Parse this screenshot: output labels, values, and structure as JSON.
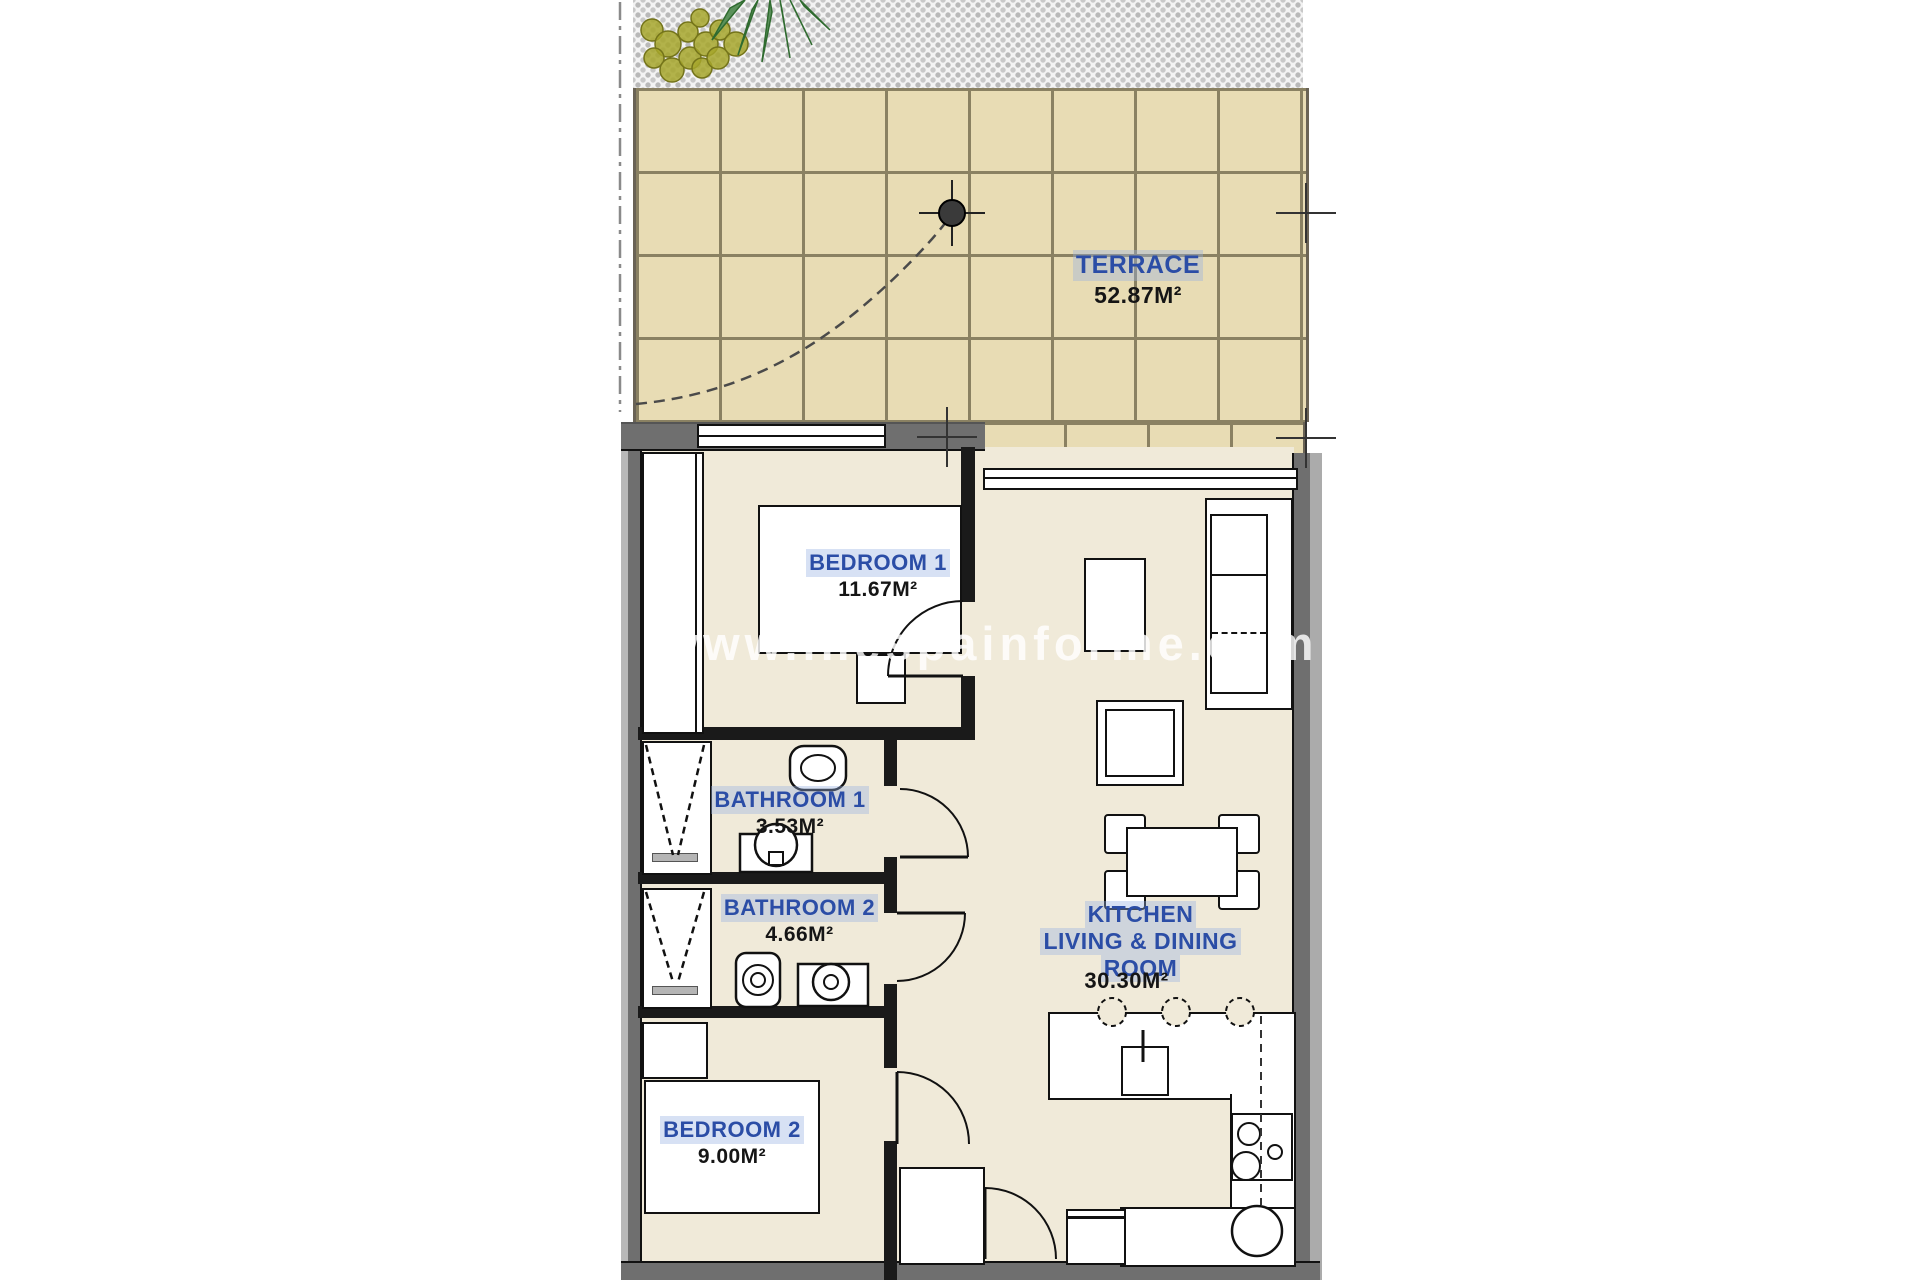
{
  "watermark": "www.inespainforme.com",
  "rooms": {
    "terrace": {
      "name": "TERRACE",
      "area": "52.87M²"
    },
    "bedroom1": {
      "name": "BEDROOM 1",
      "area": "11.67M²"
    },
    "bathroom1": {
      "name": "BATHROOM 1",
      "area": "3.53M²"
    },
    "bathroom2": {
      "name": "BATHROOM 2",
      "area": "4.66M²"
    },
    "bedroom2": {
      "name": "BEDROOM 2",
      "area": "9.00M²"
    },
    "kitchen_living": {
      "name_line1": "KITCHEN",
      "name_line2": "LIVING & DINING",
      "name_line3": "ROOM",
      "area": "30.30M²"
    }
  },
  "colors": {
    "room_label_blue": "#2b4da6",
    "area_label_black": "#151515",
    "terrace_tile": "#e8dcb4",
    "tile_grid_line": "#8a8162",
    "apartment_floor": "#f0ead9",
    "wall_gray": "#6f6f6f",
    "partition_black": "#1a1a1a",
    "gravel_dot": "#b9b9b9",
    "plant_green": "#5b915b",
    "plant_olive": "#a6a62c",
    "watermark_white": "rgba(255,255,255,0.82)"
  }
}
